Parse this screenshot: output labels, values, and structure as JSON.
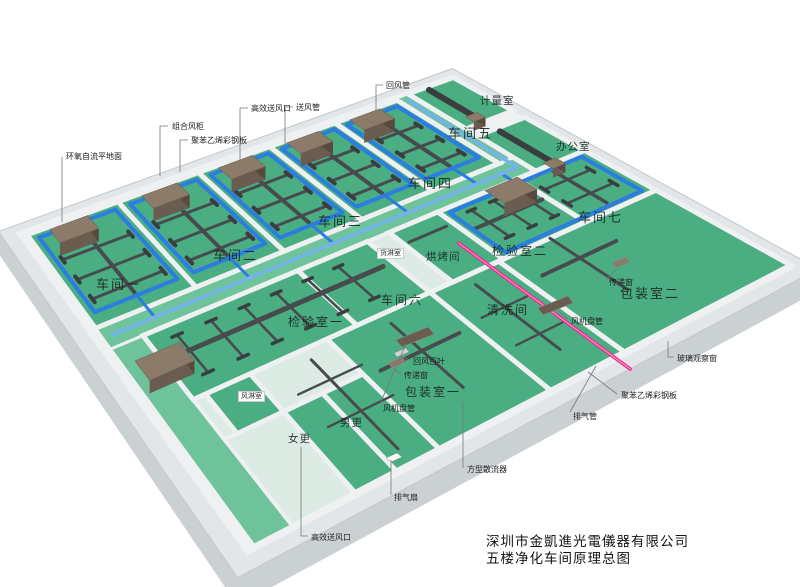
{
  "title_block": {
    "company": "深圳市金凱進光電儀器有限公司",
    "drawing_title": "五楼净化车间原理总图"
  },
  "rooms": [
    {
      "name": "车间一"
    },
    {
      "name": "车间二"
    },
    {
      "name": "车间三"
    },
    {
      "name": "车间四"
    },
    {
      "name": "车间五"
    },
    {
      "name": "车间六"
    },
    {
      "name": "车间七"
    },
    {
      "name": "检验室一"
    },
    {
      "name": "检验室二"
    },
    {
      "name": "烘烤间"
    },
    {
      "name": "清洗间"
    },
    {
      "name": "货淋室"
    },
    {
      "name": "计量室"
    },
    {
      "name": "办公室"
    },
    {
      "name": "包装室一"
    },
    {
      "name": "包装室二"
    },
    {
      "name": "风淋室"
    },
    {
      "name": "女更"
    },
    {
      "name": "男更"
    }
  ],
  "annotations": [
    {
      "text": "环氧自流平地面"
    },
    {
      "text": "组合风柜"
    },
    {
      "text": "聚苯乙烯彩钢板"
    },
    {
      "text": "高效送风口"
    },
    {
      "text": "送风管"
    },
    {
      "text": "回风管"
    },
    {
      "text": "回风百叶"
    },
    {
      "text": "传递窗"
    },
    {
      "text": "传递窗"
    },
    {
      "text": "风机盘管"
    },
    {
      "text": "风机盘管"
    },
    {
      "text": "方型散流器"
    },
    {
      "text": "排气扇"
    },
    {
      "text": "排气管"
    },
    {
      "text": "高效送风口"
    },
    {
      "text": "聚苯乙烯彩钢板"
    },
    {
      "text": "玻璃观察窗"
    }
  ],
  "colors": {
    "floor_green": "#4aae82",
    "corridor_green": "#6ec39a",
    "pale_floor": "#dcebe3",
    "white_floor": "#f2f4f4",
    "supply_duct_blue": "#2b7de0",
    "corridor_duct_blue": "#74b3ea",
    "exhaust_duct_pink": "#ee2a90",
    "duct_gray": "#474b4e",
    "duct_dark": "#3a3e41",
    "ahu_top_brown": "#8d7b69",
    "ahu_front_brown": "#6a5c4f",
    "ahu_side_brown": "#57493e",
    "wall_light": "#eef0f1",
    "band_gray": "#e3e6e8",
    "slab_gray": "#cbd0d3",
    "leader_gray": "#777777"
  }
}
